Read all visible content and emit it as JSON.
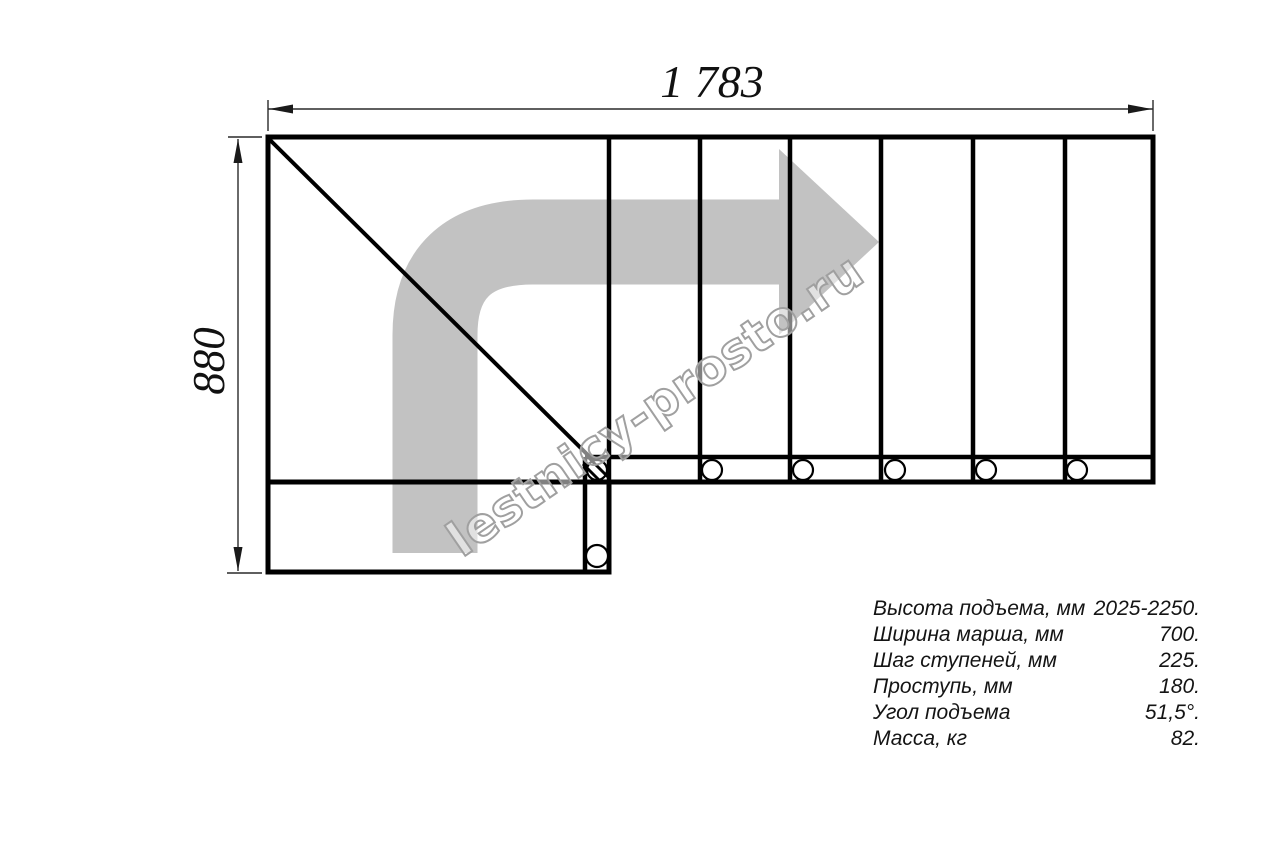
{
  "page": {
    "background": "#ffffff"
  },
  "drawing": {
    "type": "staircase-plan-top-view",
    "width_dimension_label": "1 783",
    "height_dimension_label": "880",
    "tread_count_top_flight": 6,
    "fastener_circle_count": 7,
    "arrow_color": "#c2c2c2",
    "line_color": "#000000",
    "watermark_text": "lestnicy-prosto.ru"
  },
  "specs": {
    "rows": [
      {
        "label": "Высота подъема, мм",
        "value": "2025-2250."
      },
      {
        "label": "Ширина марша, мм",
        "value": "700."
      },
      {
        "label": "Шаг ступеней, мм",
        "value": "225."
      },
      {
        "label": "Проступь, мм",
        "value": "180."
      },
      {
        "label": "Угол подъема",
        "value": "51,5°."
      },
      {
        "label": "Масса, кг",
        "value": "82."
      }
    ]
  }
}
